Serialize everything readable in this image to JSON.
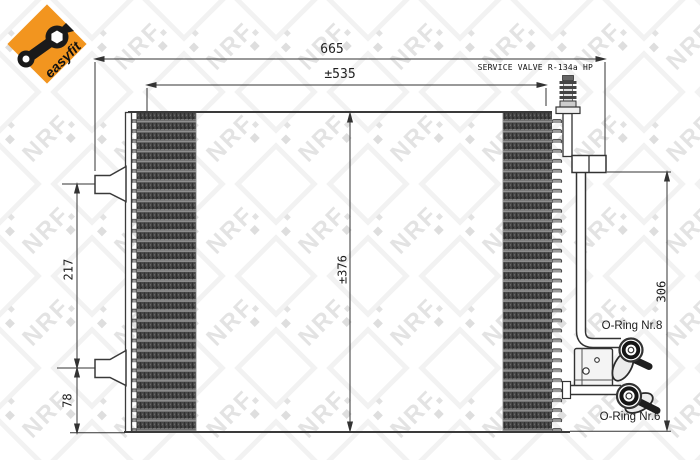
{
  "drawing": {
    "title": "condenser-technical-drawing",
    "watermark": "NRF",
    "brand_badge": {
      "label": "easyfit"
    },
    "dimensions": {
      "total_width": "665",
      "core_width": "±535",
      "core_height": "±376",
      "left_upper_span": "217",
      "left_lower_span": "78",
      "right_span": "306"
    },
    "annotations": {
      "service_valve": "SERVICE VALVE R-134a HP",
      "oring_upper": "O-Ring Nr.8",
      "oring_lower": "O-Ring Nr.6"
    },
    "colors": {
      "accent_orange": "#F2951F",
      "line": "#333333",
      "fin_dark": "#454545"
    }
  }
}
